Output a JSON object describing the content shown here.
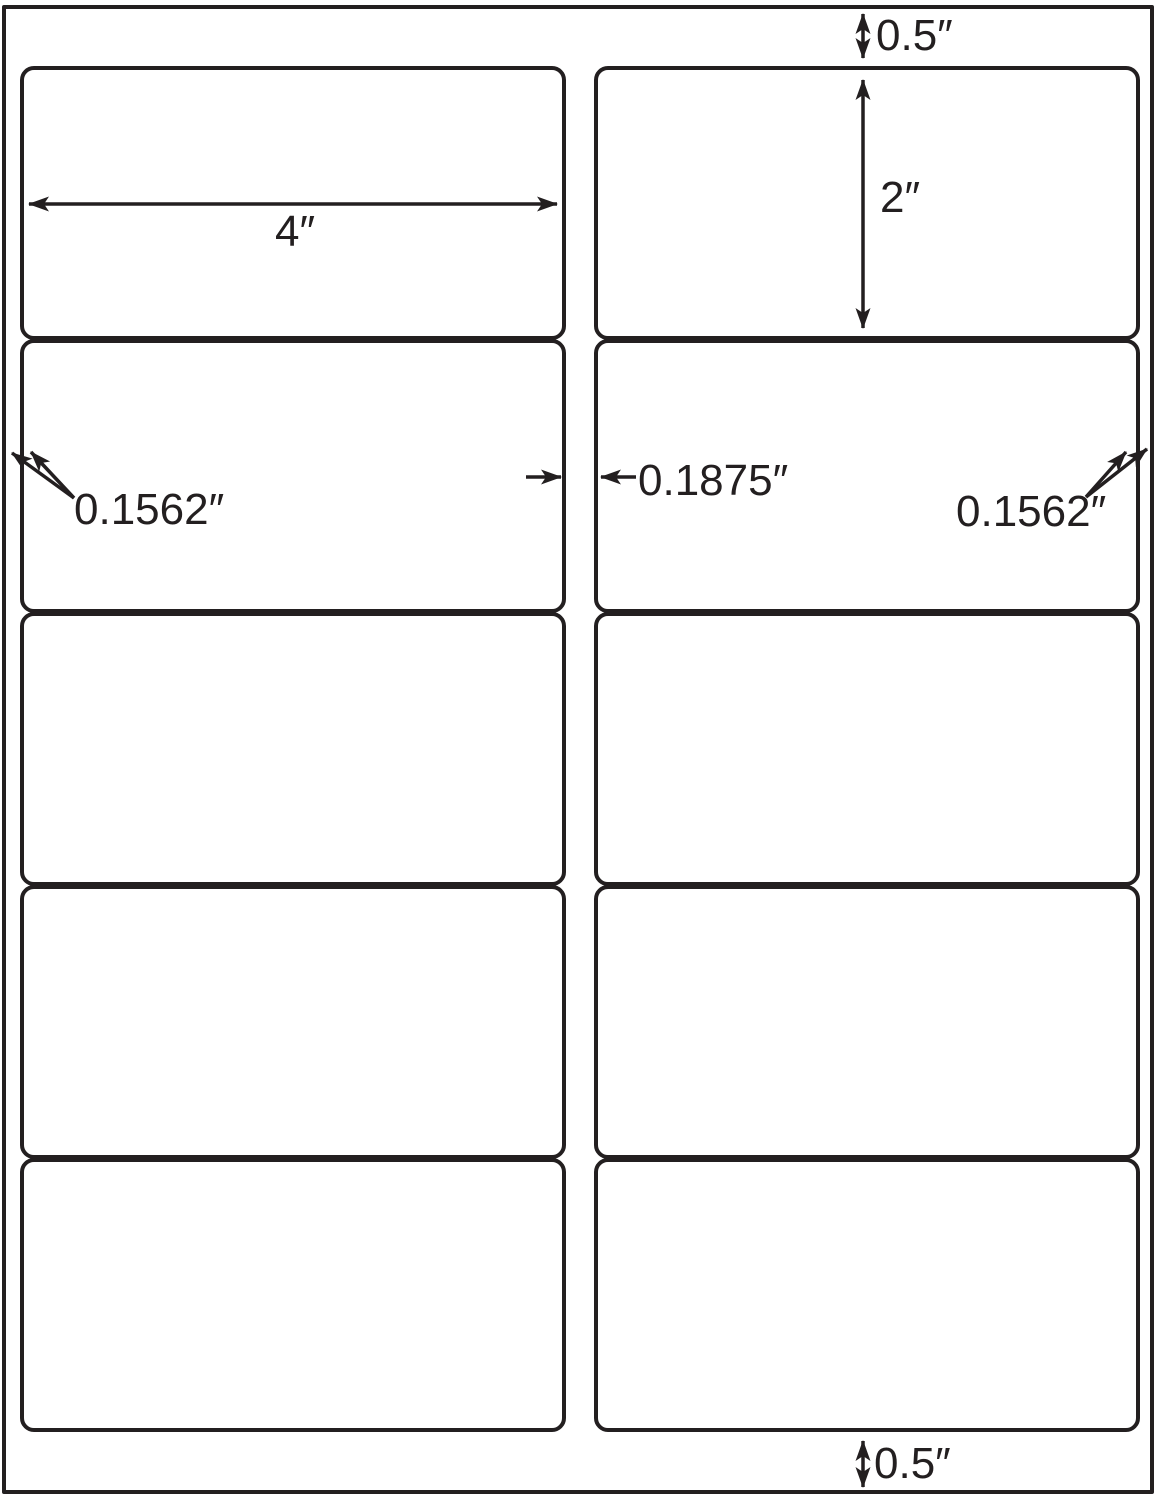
{
  "colors": {
    "background": "#ffffff",
    "ink": "#231f20"
  },
  "annotations": {
    "top_margin": "0.5″",
    "label_width": "4″",
    "label_height": "2″",
    "left_margin": "0.1562″",
    "center_gap": "0.1875″",
    "right_margin": "0.1562″",
    "bottom_margin": "0.5″"
  }
}
